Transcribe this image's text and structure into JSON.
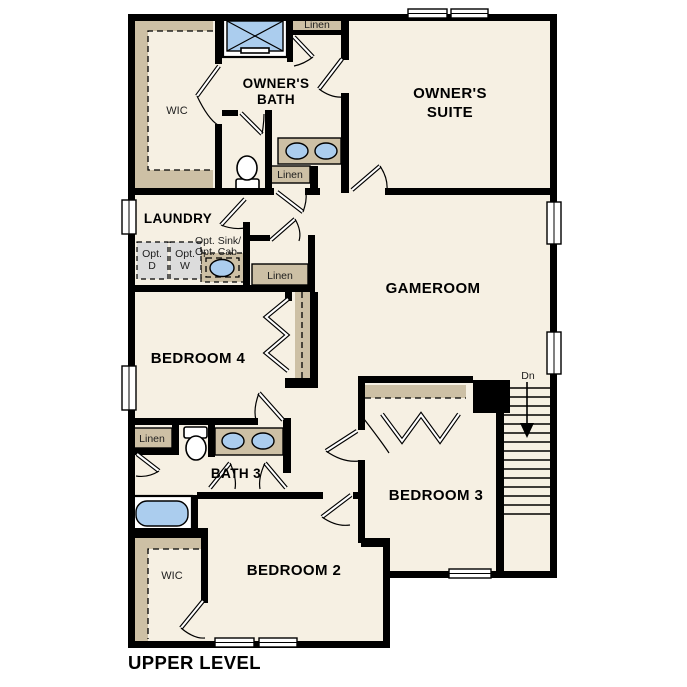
{
  "colors": {
    "background": "#ffffff",
    "floor": "#f6f0e3",
    "wall": "#000000",
    "closet_tan": "#cdc0a5",
    "fixture_blue": "#abcdee",
    "appliance_gray": "#dcdcdc",
    "text": "#000000"
  },
  "title": {
    "plan_label": "UPPER LEVEL"
  },
  "rooms": {
    "wic_upper": "WIC",
    "owners_bath_line1": "OWNER'S",
    "owners_bath_line2": "BATH",
    "owners_suite_line1": "OWNER'S",
    "owners_suite_line2": "SUITE",
    "laundry": "LAUNDRY",
    "gameroom": "GAMEROOM",
    "bedroom_4": "BEDROOM 4",
    "bath_3": "BATH 3",
    "bedroom_3": "BEDROOM 3",
    "bedroom_2": "BEDROOM 2",
    "wic_lower": "WIC"
  },
  "closets": {
    "linen_top": "Linen",
    "linen_owners_bath": "Linen",
    "linen_hall": "Linen",
    "linen_bath_3": "Linen"
  },
  "laundry_options": {
    "dryer_line1": "Opt.",
    "dryer_line2": "D",
    "washer_line1": "Opt.",
    "washer_line2": "W",
    "sink_line1": "Opt. Sink/",
    "sink_line2": "Opt. Cab"
  },
  "stairs": {
    "direction": "Dn"
  }
}
